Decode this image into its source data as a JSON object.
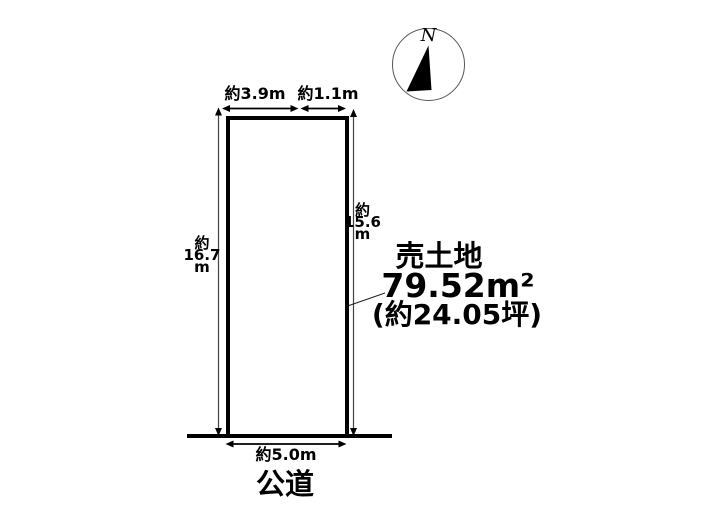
{
  "compass": {
    "label": "N"
  },
  "land": {
    "title": "売土地",
    "area": "79.52m²",
    "area_tsubo": "(約24.05坪)"
  },
  "dimensions": {
    "top_left": "約3.9m",
    "top_right": "約1.1m",
    "left": [
      "約",
      "16.7",
      "m"
    ],
    "right": [
      "約",
      "15.6",
      "m"
    ],
    "bottom": "約5.0m"
  },
  "road": {
    "label": "公道"
  },
  "colors": {
    "outline": "#000000",
    "dim_line": "#444444",
    "background": "#ffffff"
  }
}
